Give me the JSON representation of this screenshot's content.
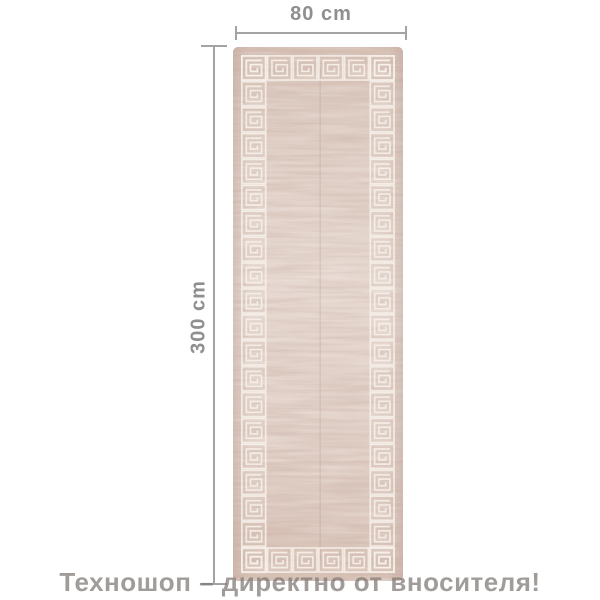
{
  "dimensions": {
    "width_label": "80 cm",
    "height_label": "300 cm"
  },
  "watermark": {
    "text": "Техношоп – директно от вносителя!"
  },
  "colors": {
    "background": "#ffffff",
    "dimension_line": "#a3a3a3",
    "dimension_text": "#8f8f8f",
    "watermark_text": "#7d7774",
    "rug_base": "#e3d4cb",
    "rug_top_shade": "#d8c2b7",
    "rug_streak": "#c0a398",
    "rug_pattern": "#f7f1eb"
  }
}
